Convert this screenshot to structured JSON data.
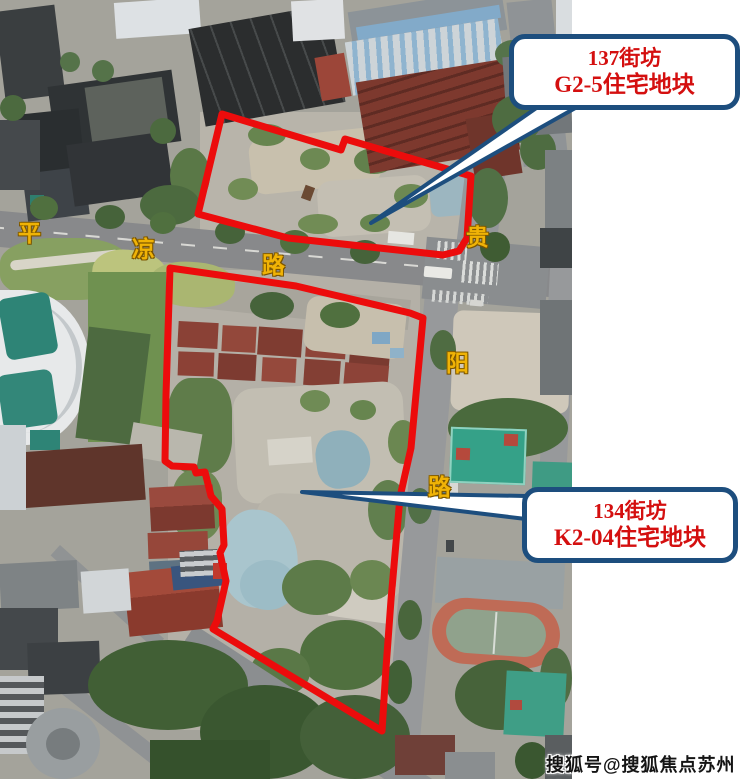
{
  "callouts": [
    {
      "line1": "137街坊",
      "line2": "G2-5住宅地块"
    },
    {
      "line1": "134街坊",
      "line2": "K2-04住宅地块"
    }
  ],
  "road_labels": {
    "pingliang": [
      "平",
      "凉",
      "路"
    ],
    "guiyang": [
      "贵",
      "阳",
      "路"
    ]
  },
  "watermark": "搜狐号@搜狐焦点苏州站",
  "colors": {
    "parcel_outline": "#ec0c0c",
    "callout_border": "#1d4e7e",
    "callout_text": "#d40f0f",
    "road_label_yellow": "#f0b306"
  }
}
